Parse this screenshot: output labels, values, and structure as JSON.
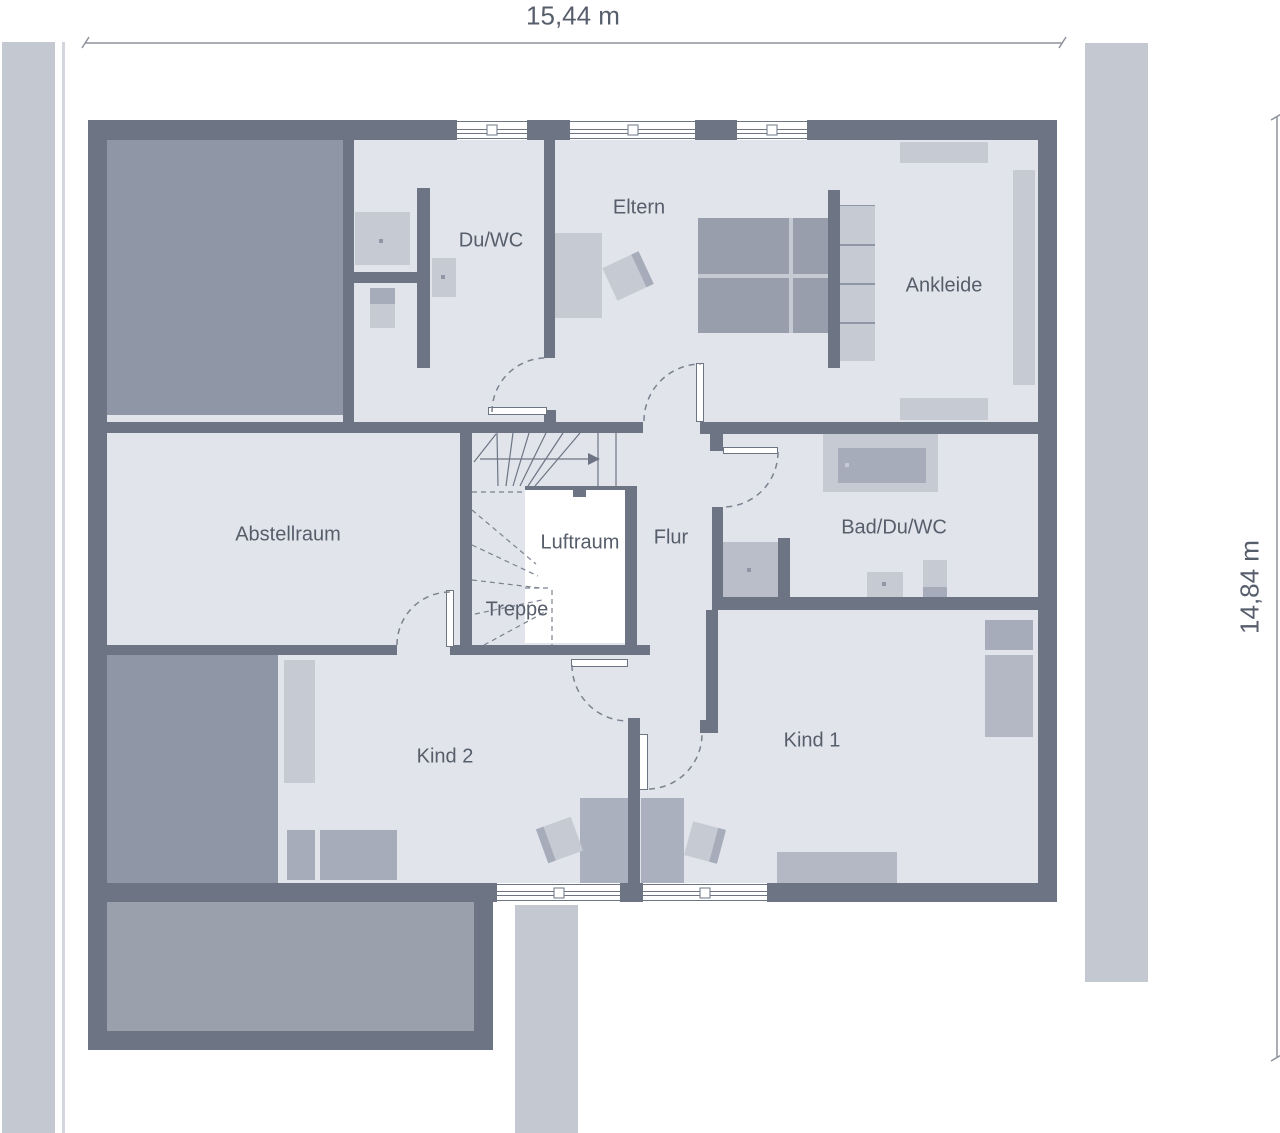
{
  "dimension_labels": {
    "width": "15,44 m",
    "height": "14,84 m"
  },
  "rooms": {
    "du_wc": {
      "label": "Du/WC"
    },
    "eltern": {
      "label": "Eltern"
    },
    "ankleide": {
      "label": "Ankleide"
    },
    "abstellraum": {
      "label": "Abstellraum"
    },
    "luftraum": {
      "label": "Luftraum"
    },
    "flur": {
      "label": "Flur"
    },
    "treppe": {
      "label": "Treppe"
    },
    "bad_du_wc": {
      "label": "Bad/Du/WC"
    },
    "kind_2": {
      "label": "Kind 2"
    },
    "kind_1": {
      "label": "Kind 1"
    }
  },
  "colors": {
    "wall": "#6d7585",
    "room": "#e1e4ea",
    "roof-fill": "#8f96a5",
    "terrace-fill": "#9ba1ac",
    "furn-light": "#c6cad3",
    "furn-mid": "#a6acba",
    "furn-desk": "#aab0bd",
    "furn-dark": "#989eac",
    "bed-light": "#b3b8c4",
    "shower": "#b9bec9",
    "outside-strip": "#c4c8d1",
    "boundary-line": "#d3d6dc",
    "text": "#575e6b",
    "dim-line": "#8d929c",
    "arc": "#7b8290"
  }
}
